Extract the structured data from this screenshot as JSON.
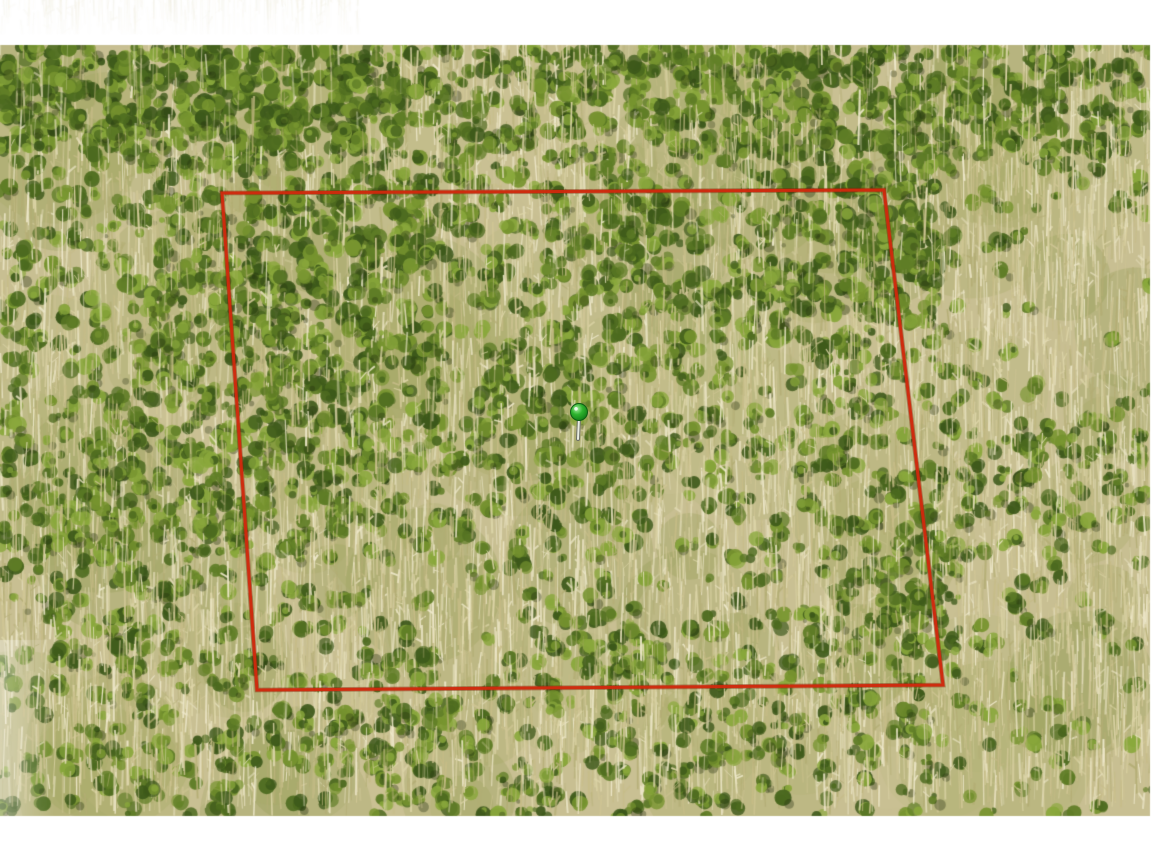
{
  "scene": {
    "type": "aerial-parcel-photo",
    "description": "Aerial/drone view of a densely wooded parcel (mix of leafless tan trees and green canopy) with a red surveyed boundary outline and a green location push-pin at the parcel center",
    "background_color": "#ffffff"
  },
  "photo": {
    "left": 0,
    "top": 45,
    "right": 1150,
    "bottom": 816,
    "base_color": "#c8bf92",
    "palette": {
      "greens": [
        "#77942f",
        "#5f7d26",
        "#4c6a1f",
        "#8aa83c",
        "#3c581a"
      ],
      "pale_streaks": [
        "#ddd5a8",
        "#d0c695",
        "#c6bc87",
        "#e6dfbd",
        "#b3ad74"
      ],
      "bright_streak": "#efe9cc",
      "shadow": "#222d0e",
      "patches": [
        "#b7b57c",
        "#a7a865",
        "#939a52",
        "#cdc496"
      ]
    },
    "faded_top_left_strip": {
      "x": 0,
      "y": 0,
      "width": 360,
      "height": 34
    },
    "texture_zones": {
      "green": [
        {
          "x": 300,
          "y": 330,
          "rx": 190,
          "ry": 140,
          "s": 0.38
        },
        {
          "x": 200,
          "y": 480,
          "rx": 150,
          "ry": 100,
          "s": 0.3
        },
        {
          "x": 340,
          "y": 210,
          "rx": 150,
          "ry": 90,
          "s": 0.25
        },
        {
          "x": 860,
          "y": 250,
          "rx": 110,
          "ry": 90,
          "s": 0.35
        },
        {
          "x": 915,
          "y": 590,
          "rx": 70,
          "ry": 110,
          "s": 0.45
        },
        {
          "x": 560,
          "y": 420,
          "rx": 90,
          "ry": 70,
          "s": 0.22
        },
        {
          "x": 640,
          "y": 260,
          "rx": 80,
          "ry": 60,
          "s": 0.22
        },
        {
          "x": 380,
          "y": 740,
          "rx": 90,
          "ry": 60,
          "s": 0.3
        },
        {
          "x": 590,
          "y": 680,
          "rx": 70,
          "ry": 50,
          "s": 0.28
        },
        {
          "x": 760,
          "y": 750,
          "rx": 80,
          "ry": 55,
          "s": 0.28
        },
        {
          "x": 1060,
          "y": 450,
          "rx": 80,
          "ry": 70,
          "s": 0.22
        },
        {
          "x": 90,
          "y": 620,
          "rx": 90,
          "ry": 80,
          "s": 0.3
        }
      ],
      "pale": [
        {
          "x": 500,
          "y": 90,
          "rx": 110,
          "ry": 60,
          "s": 0.45
        },
        {
          "x": 1040,
          "y": 300,
          "rx": 120,
          "ry": 140,
          "s": 0.25
        },
        {
          "x": 700,
          "y": 560,
          "rx": 160,
          "ry": 90,
          "s": 0.2
        },
        {
          "x": 450,
          "y": 600,
          "rx": 120,
          "ry": 70,
          "s": 0.15
        }
      ]
    }
  },
  "parcel_boundary": {
    "color": "#cf2a0d",
    "shadow_color": "#7a1d04",
    "stroke_width": 3,
    "corners": [
      [
        222,
        193
      ],
      [
        884,
        190
      ],
      [
        943,
        685
      ],
      [
        257,
        690
      ]
    ]
  },
  "marker": {
    "x": 579,
    "y": 412,
    "head_radius": 8.5,
    "head_color": "#2db32d",
    "head_highlight": "#a6eea0",
    "head_dark": "#0f7a16",
    "head_rim": "#0c5c12",
    "stem_color": "#e9ede3",
    "stem_outline": "#6b6f66",
    "stem_length": 27
  }
}
